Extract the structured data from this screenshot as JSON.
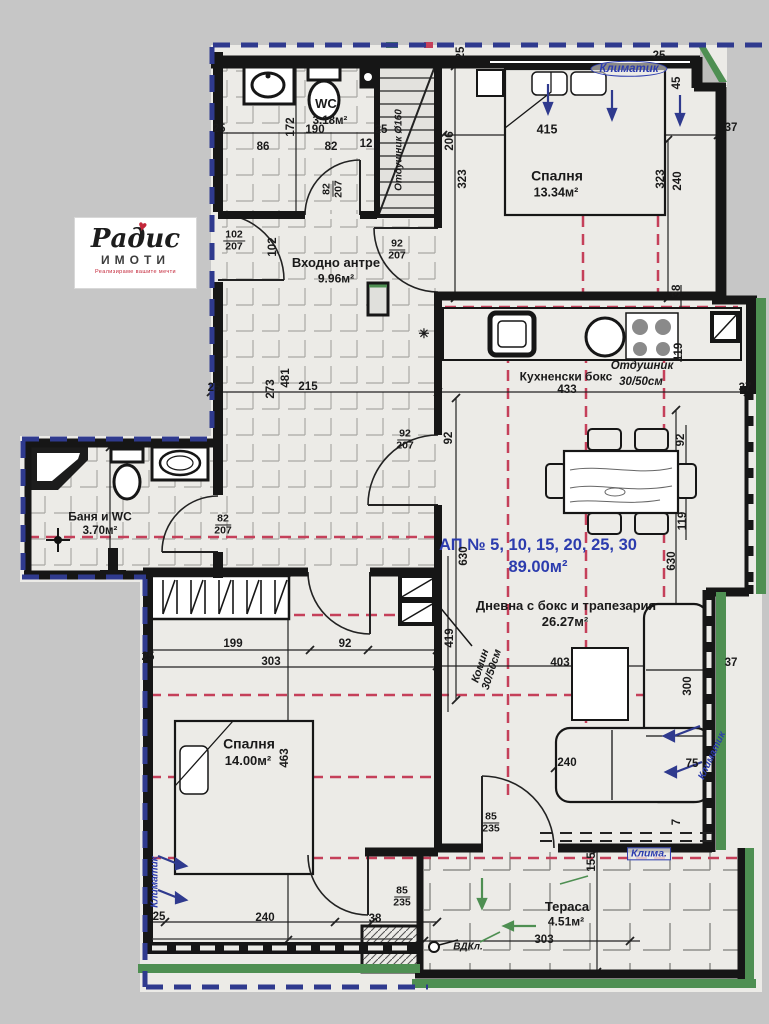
{
  "colors": {
    "blue": "#2c3cae",
    "red": "#c5405a",
    "green": "#4e8f52",
    "ink": "#1a1a1a",
    "wall": "#161616",
    "paper": "#ecebe7",
    "page": "#c6c6c6",
    "logo_red": "#c4273a"
  },
  "logo": {
    "brand": "Радис",
    "sub": "ИМОТИ",
    "tagline": "Реализираме вашите мечти",
    "heart": "♥"
  },
  "apartment": {
    "title": "АП № 5, 10, 15, 20, 25, 30",
    "area": "89.00м²",
    "tx": 538,
    "ty": 546,
    "ax": 538,
    "ay": 568
  },
  "rooms": [
    {
      "id": "wc",
      "name": "WC",
      "area": "3.18м²",
      "nx": 326,
      "ny": 104,
      "ns": 13,
      "ax": 330,
      "ay": 121,
      "as": 11.5
    },
    {
      "id": "bedroom-1",
      "name": "Спалня",
      "area": "13.34м²",
      "nx": 557,
      "ny": 176,
      "ns": 14,
      "ax": 556,
      "ay": 193,
      "as": 12.5
    },
    {
      "id": "entry-hall",
      "name": "Входно антре",
      "area": "9.96м²",
      "nx": 336,
      "ny": 263,
      "ns": 13,
      "ax": 336,
      "ay": 279,
      "as": 12
    },
    {
      "id": "kitchen",
      "name": "Кухненски бокс",
      "area": "",
      "nx": 566,
      "ny": 377,
      "ns": 12
    },
    {
      "id": "bathroom",
      "name": "Баня и WC",
      "area": "3.70м²",
      "nx": 100,
      "ny": 517,
      "ns": 12,
      "ax": 100,
      "ay": 531,
      "as": 11.5
    },
    {
      "id": "living",
      "name": "Дневна с бокс и трапезария",
      "area": "26.27м²",
      "nx": 566,
      "ny": 606,
      "ns": 13,
      "ax": 565,
      "ay": 622,
      "as": 13
    },
    {
      "id": "bedroom-2",
      "name": "Спалня",
      "area": "14.00м²",
      "nx": 249,
      "ny": 744,
      "ns": 14,
      "ax": 248,
      "ay": 761,
      "as": 13
    },
    {
      "id": "terrace",
      "name": "Тераса",
      "area": "4.51м²",
      "nx": 567,
      "ny": 907,
      "ns": 13,
      "ax": 566,
      "ay": 922,
      "as": 12
    }
  ],
  "labels": [
    {
      "n": "dim-25-wc-left",
      "t": "25",
      "x": 219,
      "y": 129
    },
    {
      "n": "dim-86",
      "t": "86",
      "x": 263,
      "y": 147
    },
    {
      "n": "dim-190",
      "t": "190",
      "x": 315,
      "y": 130
    },
    {
      "n": "dim-172",
      "t": "172",
      "x": 291,
      "y": 127,
      "r": -90
    },
    {
      "n": "dim-82-wc",
      "t": "82",
      "x": 331,
      "y": 147
    },
    {
      "n": "dim-12",
      "t": "12",
      "x": 366,
      "y": 144
    },
    {
      "n": "dim-25-wc-right",
      "t": "25",
      "x": 381,
      "y": 130
    },
    {
      "n": "dim-102-rot",
      "t": "102",
      "x": 273,
      "y": 247,
      "r": -90
    },
    {
      "n": "vent-label-wc",
      "t": "Отдушник Ø160",
      "x": 400,
      "y": 150,
      "r": -90,
      "s": 10,
      "i": 1
    },
    {
      "n": "dim-25-top-1",
      "t": "25",
      "x": 461,
      "y": 53,
      "r": -90
    },
    {
      "n": "dim-25-top-2",
      "t": "25",
      "x": 659,
      "y": 56
    },
    {
      "n": "dim-45",
      "t": "45",
      "x": 677,
      "y": 83,
      "r": -90
    },
    {
      "n": "dim-37-topright",
      "t": "37",
      "x": 731,
      "y": 128
    },
    {
      "n": "climate-bedroom1",
      "t": "Климатик",
      "x": 629,
      "y": 69,
      "c": "blue",
      "i": 1,
      "s": 11.5,
      "cls": "oval"
    },
    {
      "n": "dim-206",
      "t": "206",
      "x": 450,
      "y": 141,
      "r": -90
    },
    {
      "n": "dim-415",
      "t": "415",
      "x": 547,
      "y": 130,
      "s": 12.5
    },
    {
      "n": "dim-323-left",
      "t": "323",
      "x": 463,
      "y": 179,
      "r": -90
    },
    {
      "n": "dim-323-right",
      "t": "323",
      "x": 661,
      "y": 179,
      "r": -90
    },
    {
      "n": "dim-240-bedroom1",
      "t": "240",
      "x": 678,
      "y": 181,
      "r": -90
    },
    {
      "n": "dim-25-hall",
      "t": "25",
      "x": 214,
      "y": 388
    },
    {
      "n": "dim-273",
      "t": "273",
      "x": 271,
      "y": 389,
      "r": -90
    },
    {
      "n": "dim-481",
      "t": "481",
      "x": 286,
      "y": 378,
      "r": -90
    },
    {
      "n": "dim-215",
      "t": "215",
      "x": 308,
      "y": 387
    },
    {
      "n": "symbol-light-point",
      "t": "✳",
      "x": 424,
      "y": 334,
      "s": 13
    },
    {
      "n": "dim-433",
      "t": "433",
      "x": 567,
      "y": 390
    },
    {
      "n": "vent-label-kitchen-1",
      "t": "Отдушник",
      "x": 642,
      "y": 366,
      "i": 1
    },
    {
      "n": "vent-label-kitchen-2",
      "t": "30/50см",
      "x": 641,
      "y": 382,
      "i": 1
    },
    {
      "n": "dim-38-shaft",
      "t": "38",
      "x": 677,
      "y": 291,
      "r": -90
    },
    {
      "n": "dim-119-shaft",
      "t": "119",
      "x": 679,
      "y": 352,
      "r": -90
    },
    {
      "n": "dim-37-right",
      "t": "37",
      "x": 745,
      "y": 388
    },
    {
      "n": "dim-92-right",
      "t": "92",
      "x": 681,
      "y": 440,
      "r": -90
    },
    {
      "n": "dim-119-right",
      "t": "119",
      "x": 683,
      "y": 521,
      "r": -90
    },
    {
      "n": "dim-630-left",
      "t": "630",
      "x": 464,
      "y": 556,
      "r": -90
    },
    {
      "n": "dim-630-right",
      "t": "630",
      "x": 672,
      "y": 561,
      "r": -90
    },
    {
      "n": "dim-419",
      "t": "419",
      "x": 450,
      "y": 638,
      "r": -90
    },
    {
      "n": "chimney-label",
      "t": "Комин\n30/50см",
      "x": 487,
      "y": 668,
      "r": -72,
      "i": 1,
      "s": 11
    },
    {
      "n": "dim-403",
      "t": "403",
      "x": 560,
      "y": 663
    },
    {
      "n": "dim-37-living",
      "t": "37",
      "x": 731,
      "y": 663
    },
    {
      "n": "dim-300",
      "t": "300",
      "x": 688,
      "y": 686,
      "r": -90
    },
    {
      "n": "dim-240-living",
      "t": "240",
      "x": 567,
      "y": 763
    },
    {
      "n": "dim-75",
      "t": "75",
      "x": 692,
      "y": 764
    },
    {
      "n": "dim-7",
      "t": "7",
      "x": 677,
      "y": 822,
      "r": -90
    },
    {
      "n": "climate-living",
      "t": "Климатик",
      "x": 713,
      "y": 756,
      "r": -65,
      "c": "blue",
      "i": 1,
      "s": 10
    },
    {
      "n": "dim-199",
      "t": "199",
      "x": 233,
      "y": 644
    },
    {
      "n": "dim-303-bedroom2",
      "t": "303",
      "x": 271,
      "y": 662
    },
    {
      "n": "dim-92-bedroom2",
      "t": "92",
      "x": 345,
      "y": 644
    },
    {
      "n": "dim-25-bedroom2",
      "t": "25",
      "x": 148,
      "y": 657
    },
    {
      "n": "dim-463",
      "t": "463",
      "x": 285,
      "y": 758,
      "r": -90
    },
    {
      "n": "climate-bedroom2",
      "t": "Климатик",
      "x": 156,
      "y": 882,
      "r": -90,
      "c": "blue",
      "i": 1,
      "s": 10
    },
    {
      "n": "dim-25-bedroom2-bottom",
      "t": "25",
      "x": 159,
      "y": 917
    },
    {
      "n": "dim-240-bedroom2",
      "t": "240",
      "x": 265,
      "y": 918
    },
    {
      "n": "dim-38-bedroom2",
      "t": "38",
      "x": 375,
      "y": 919
    },
    {
      "n": "climate-terrace",
      "t": "Клима.",
      "x": 649,
      "y": 854,
      "c": "blue",
      "i": 1,
      "s": 10.5,
      "cls": "box"
    },
    {
      "n": "dim-155",
      "t": "155",
      "x": 592,
      "y": 862,
      "r": -90
    },
    {
      "n": "dim-303-terrace",
      "t": "303",
      "x": 544,
      "y": 940
    },
    {
      "n": "drain-label",
      "t": "ВДКл.",
      "x": 468,
      "y": 948,
      "s": 10,
      "i": 1
    },
    {
      "n": "dim-92-door",
      "t": "92",
      "x": 449,
      "y": 438,
      "r": -90
    }
  ],
  "fractions": [
    {
      "n": "door-size-entrance",
      "top": "102",
      "bottom": "207",
      "x": 234,
      "y": 241
    },
    {
      "n": "door-size-wc",
      "top": "82",
      "bottom": "207",
      "x": 333,
      "y": 189,
      "r": -90
    },
    {
      "n": "door-size-hall-kitchen",
      "top": "92",
      "bottom": "207",
      "x": 397,
      "y": 250
    },
    {
      "n": "door-size-hall-living",
      "top": "92",
      "bottom": "207",
      "x": 405,
      "y": 440
    },
    {
      "n": "door-size-bathroom",
      "top": "82",
      "bottom": "207",
      "x": 223,
      "y": 525
    },
    {
      "n": "door-size-terrace-bedroom",
      "top": "85",
      "bottom": "235",
      "x": 402,
      "y": 897
    },
    {
      "n": "door-size-terrace-living",
      "top": "85",
      "bottom": "235",
      "x": 491,
      "y": 823
    }
  ]
}
